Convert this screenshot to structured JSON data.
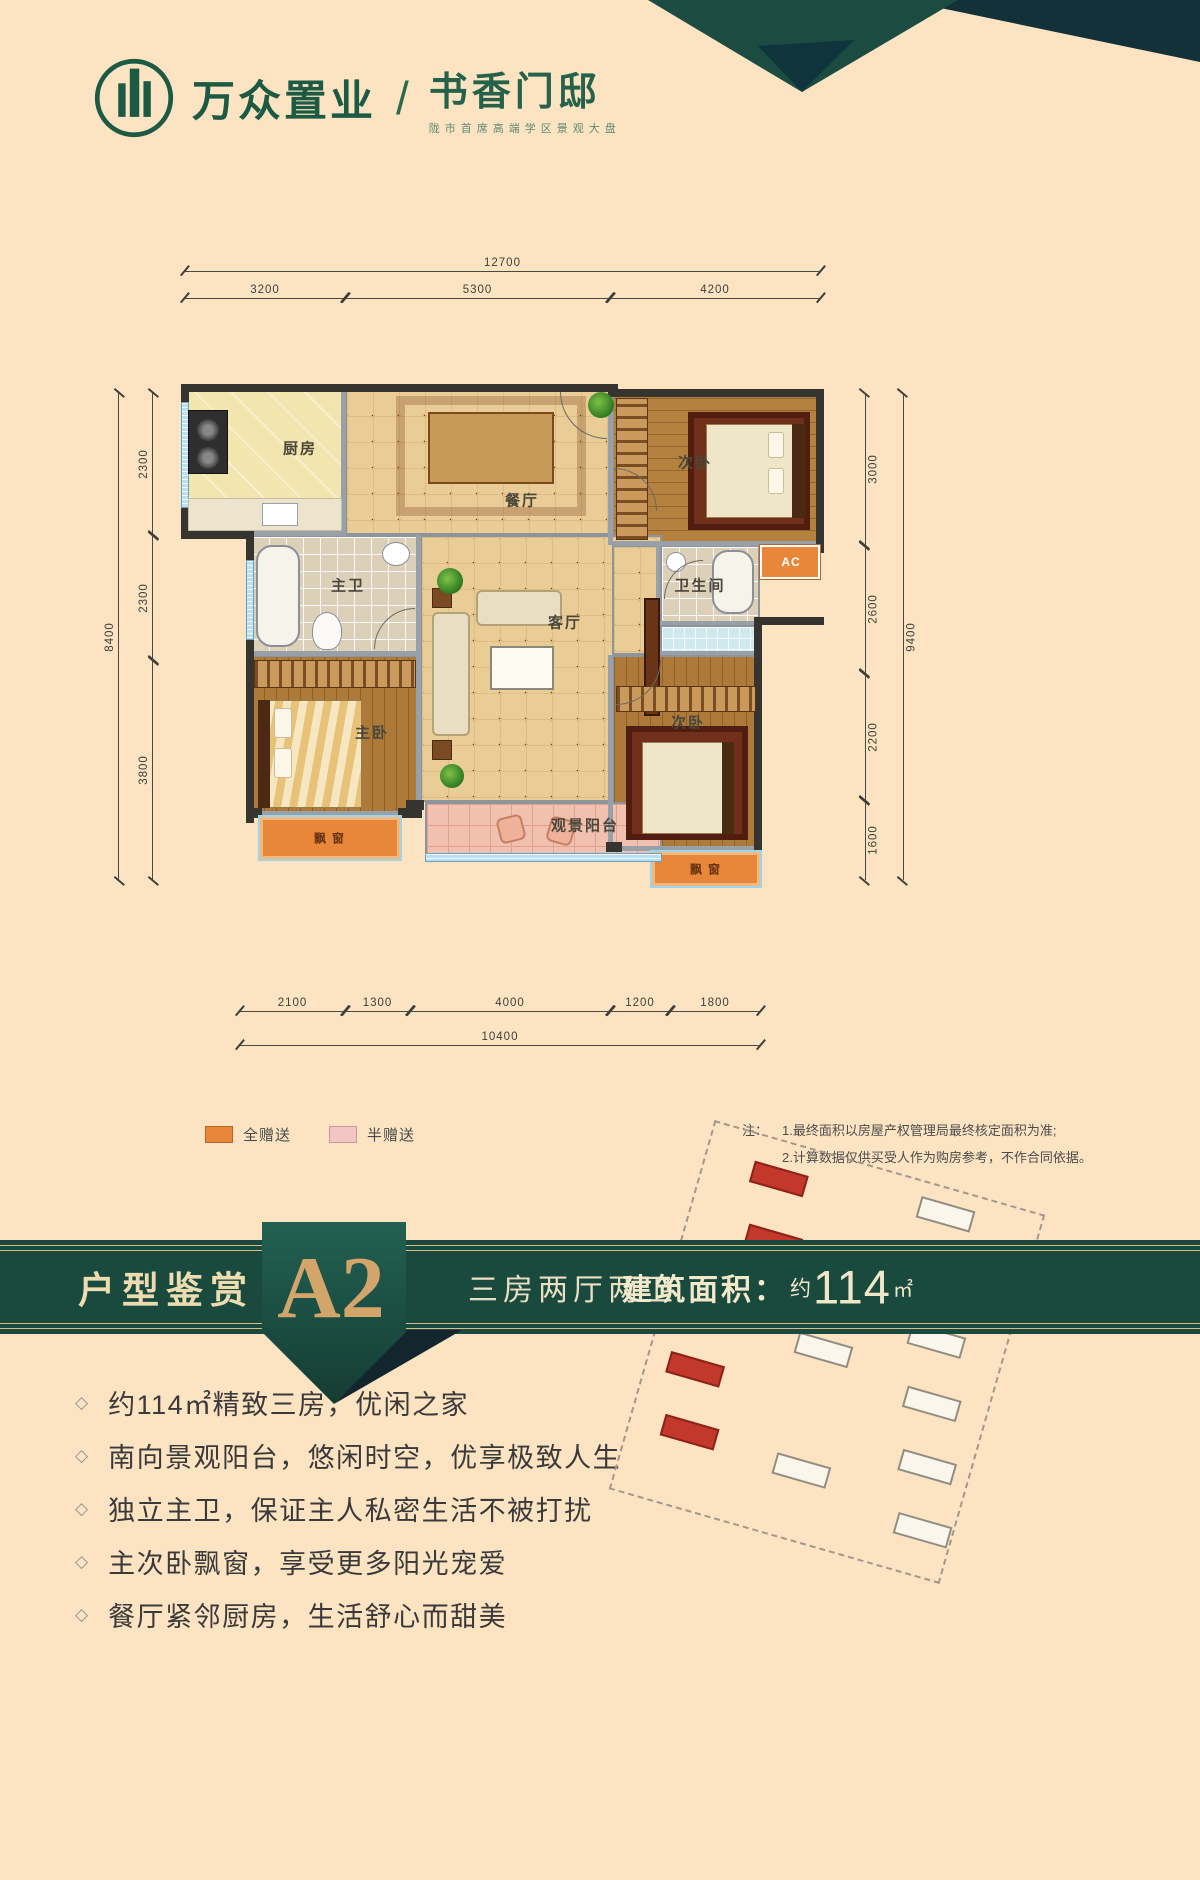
{
  "brand": {
    "company": "万众置业",
    "divider": "/",
    "project": "书香门邸",
    "tagline": "陇市首席高端学区景观大盘"
  },
  "floorplan": {
    "rooms": {
      "kitchen": "厨房",
      "dining": "餐厅",
      "bedroom_top": "次卧",
      "master_bath": "主卫",
      "master_bedroom": "主卧",
      "living": "客厅",
      "bathroom": "卫生间",
      "bedroom_bottom": "次卧",
      "balcony": "观景阳台",
      "bay_window_master": "飘窗",
      "bay_window_second": "飘窗",
      "ac": "AC"
    },
    "dims": {
      "top_total": "12700",
      "top": [
        "3200",
        "5300",
        "4200"
      ],
      "left_total": "8400",
      "left": [
        "2300",
        "2300",
        "3800"
      ],
      "right_total": "9400",
      "right": [
        "3000",
        "2600",
        "2200",
        "1600"
      ],
      "bottom_total": "10400",
      "bottom": [
        "2100",
        "1300",
        "4000",
        "1200",
        "1800"
      ]
    }
  },
  "legend": {
    "full_gift": {
      "label": "全赠送",
      "color": "#e8873a"
    },
    "half_gift": {
      "label": "半赠送",
      "color": "#f3c6c6"
    }
  },
  "note": {
    "prefix": "注：",
    "line1": "1.最终面积以房屋产权管理局最终核定面积为准;",
    "line2": "2.计算数据仅供买受人作为购房参考，不作合同依据。"
  },
  "banner": {
    "section_title": "户型鉴赏",
    "unit_code": "A2",
    "layout_desc": "三房两厅两卫",
    "area_label": "建筑面积：",
    "area_prefix": "约",
    "area_value": "114",
    "area_unit": "㎡"
  },
  "features": [
    "约114㎡精致三房，优闲之家",
    "南向景观阳台，悠闲时空，优享极致人生",
    "独立主卫，保证主人私密生活不被打扰",
    "主次卧飘窗，享受更多阳光宠爱",
    "餐厅紧邻厨房，生活舒心而甜美"
  ],
  "ui": {
    "bullet_icon": "◇"
  },
  "colors": {
    "background": "#fce4c3",
    "banner_green": "#1a493d",
    "accent_gold": "#d2a56b",
    "highlight_red": "#c2382a",
    "full_gift_orange": "#e8873a",
    "half_gift_pink": "#f3c6c6"
  }
}
